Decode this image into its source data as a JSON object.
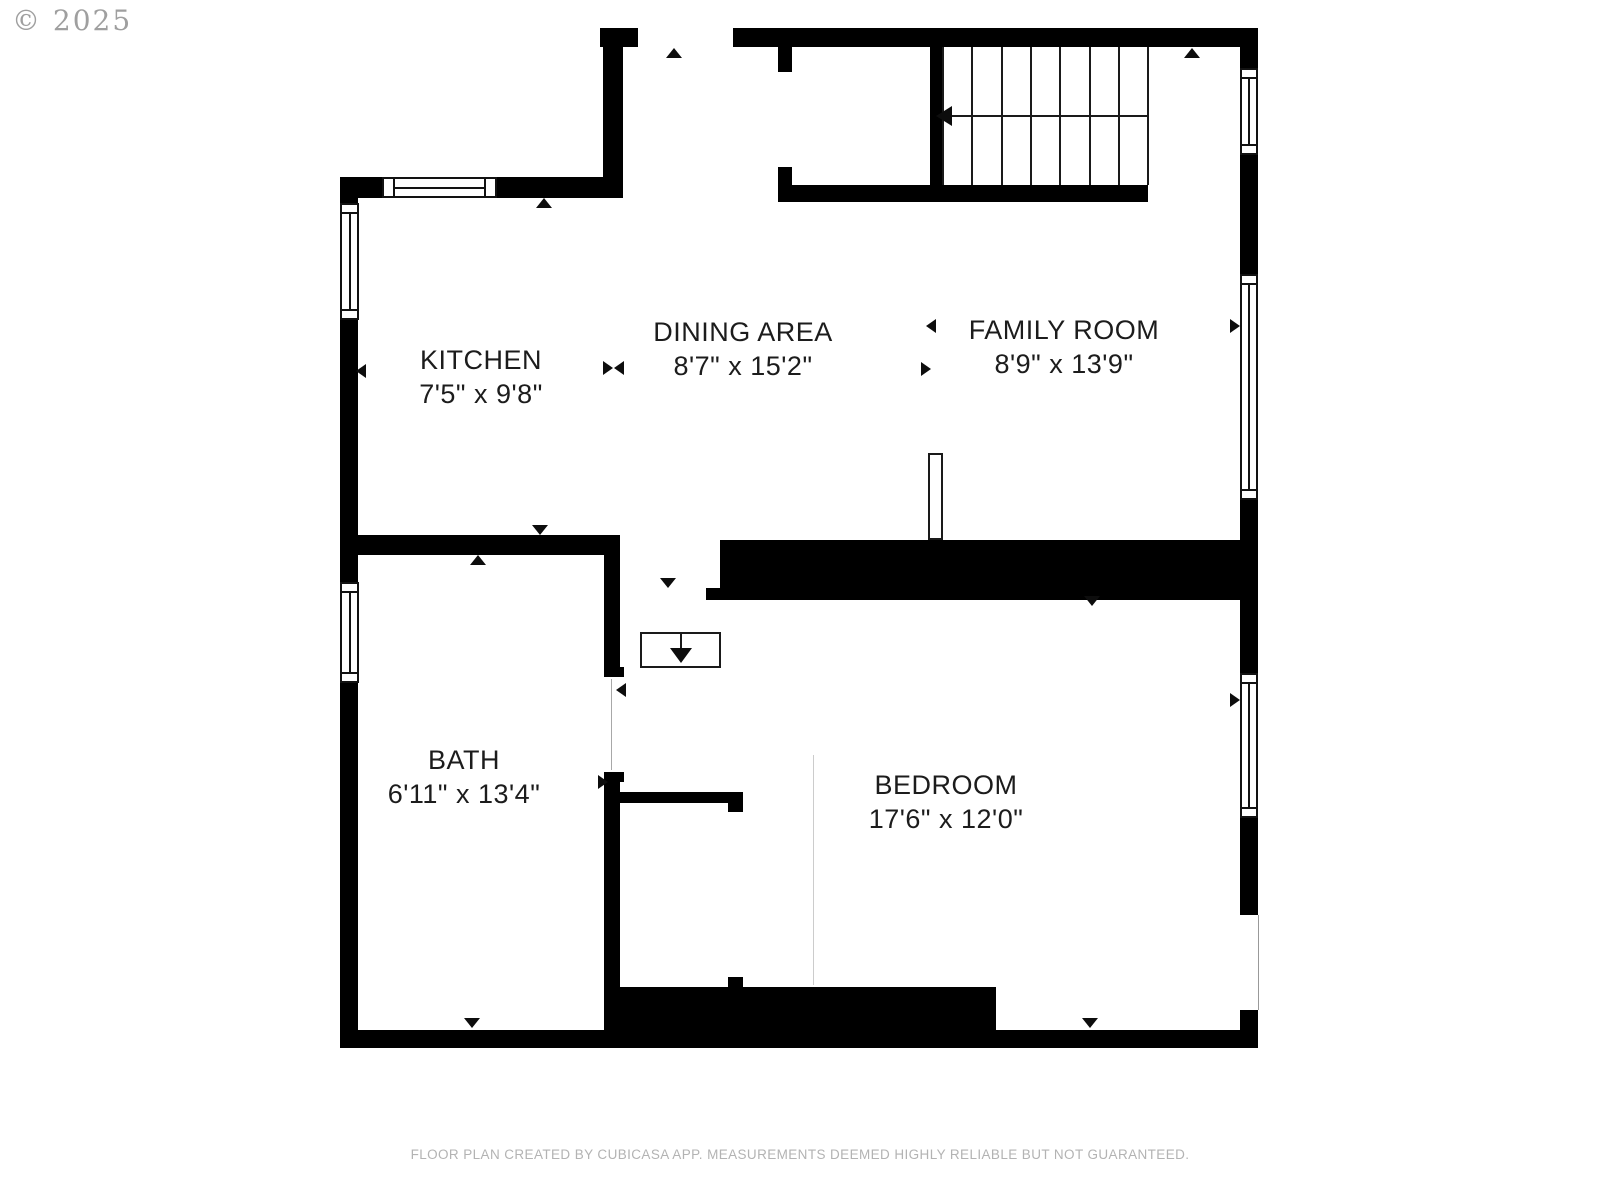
{
  "watermark": {
    "copyright": "© 2025"
  },
  "footer": {
    "disclaimer": "FLOOR PLAN CREATED BY CUBICASA APP. MEASUREMENTS DEEMED HIGHLY RELIABLE BUT NOT GUARANTEED."
  },
  "rooms": {
    "kitchen": {
      "name": "KITCHEN",
      "dimensions": "7'5\" x 9'8\""
    },
    "dining": {
      "name": "DINING AREA",
      "dimensions": "8'7\" x 15'2\""
    },
    "family": {
      "name": "FAMILY ROOM",
      "dimensions": "8'9\" x 13'9\""
    },
    "bath": {
      "name": "BATH",
      "dimensions": "6'11\" x 13'4\""
    },
    "bedroom": {
      "name": "BEDROOM",
      "dimensions": "17'6\" x 12'0\""
    }
  },
  "stairs": {
    "treads": 7,
    "direction": "down-left"
  },
  "colors": {
    "wall": "#000000",
    "label": "#1c1c1c",
    "muted_text": "#b3b3b3",
    "watermark": "#8f8f8f",
    "background": "#ffffff"
  }
}
